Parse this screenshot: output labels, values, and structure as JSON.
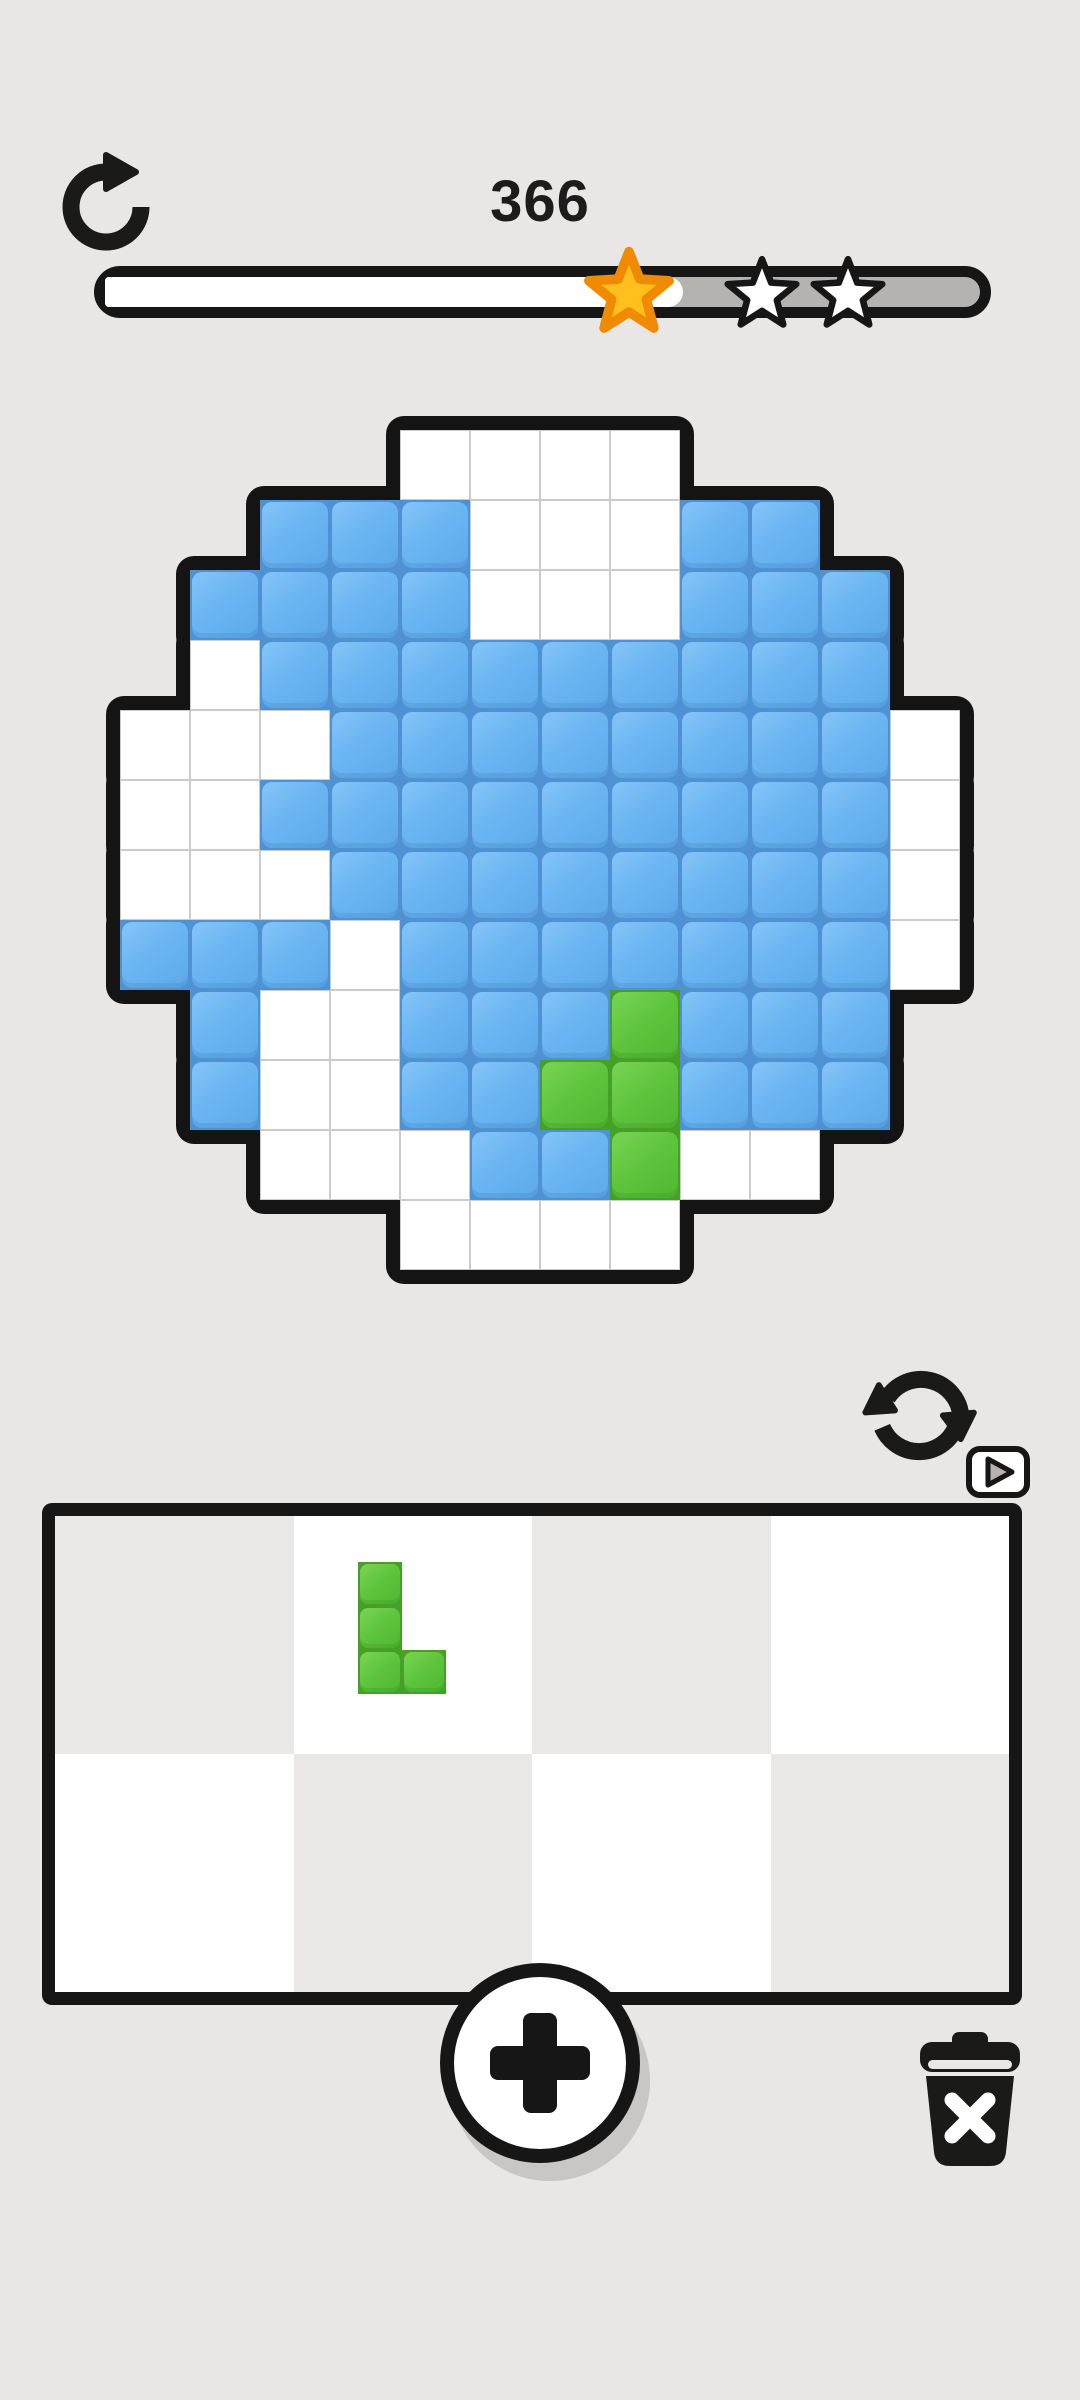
{
  "app": {
    "background_color": "#e8e7e5",
    "ink_color": "#161616"
  },
  "header": {
    "score": "366",
    "restart_icon": "rotate-clockwise-arrow",
    "progress": {
      "percent_filled": 66,
      "fill_color": "#ffffff",
      "track_color": "#b4b3b2",
      "border_color": "#161616",
      "stars": [
        {
          "state": "earned",
          "fill": "#ffc01e",
          "stroke": "#f08a00",
          "x": 629,
          "y": 290,
          "size": 96
        },
        {
          "state": "locked",
          "fill": "#ffffff",
          "stroke": "#161616",
          "x": 762,
          "y": 292,
          "size": 82
        },
        {
          "state": "locked",
          "fill": "#ffffff",
          "stroke": "#161616",
          "x": 848,
          "y": 292,
          "size": 82
        }
      ]
    }
  },
  "board": {
    "description": "pixel-art globe puzzle grid",
    "grid_cols": 12,
    "grid_rows": 12,
    "cell_px": 70,
    "origin_x": 120,
    "origin_y": 430,
    "legend": {
      ".": "outside-shape",
      "W": "empty-white-cell",
      "B": "blue-filled-cell",
      "G": "green-filled-cell"
    },
    "rows": [
      "....WWWW....",
      "..BBBWWWBB..",
      ".BBBBWWWBBB.",
      ".WBBBBBBBBB.",
      "WWWBBBBBBBBW",
      "WWBBBBBBBBBW",
      "WWWBBBBBBBBW",
      "BBBWBBBBBBBW",
      ".BWWBBBGBBB.",
      ".BWWBBGGBBB.",
      "..WWWBBGWW..",
      "....WWWW...."
    ],
    "colors": {
      "blue": "#6ab5f2",
      "blue_edge": "#4e92d3",
      "green": "#5dc43c",
      "green_edge": "#46a028",
      "white": "#ffffff",
      "gridline": "#cccbca",
      "outline": "#141414"
    }
  },
  "piece_controls": {
    "rotate_icon": "sync-rotate-arrows",
    "tutorial_badge_icon": "play-triangle"
  },
  "tray": {
    "cols": 4,
    "rows": 2,
    "checker_light": "#ffffff",
    "checker_dark": "#e9e8e6",
    "border_color": "#161616",
    "piece": {
      "shape": "L-tetromino",
      "color": "#5dc43c",
      "block_px": 44,
      "origin_x": 358,
      "origin_y": 1562,
      "blocks": [
        [
          0,
          0
        ],
        [
          0,
          1
        ],
        [
          0,
          2
        ],
        [
          1,
          2
        ]
      ],
      "slot": "top-row-second-column"
    }
  },
  "footer": {
    "add_piece_button": {
      "symbol": "plus"
    },
    "trash_button": {
      "icon": "trash-can-with-x"
    }
  }
}
